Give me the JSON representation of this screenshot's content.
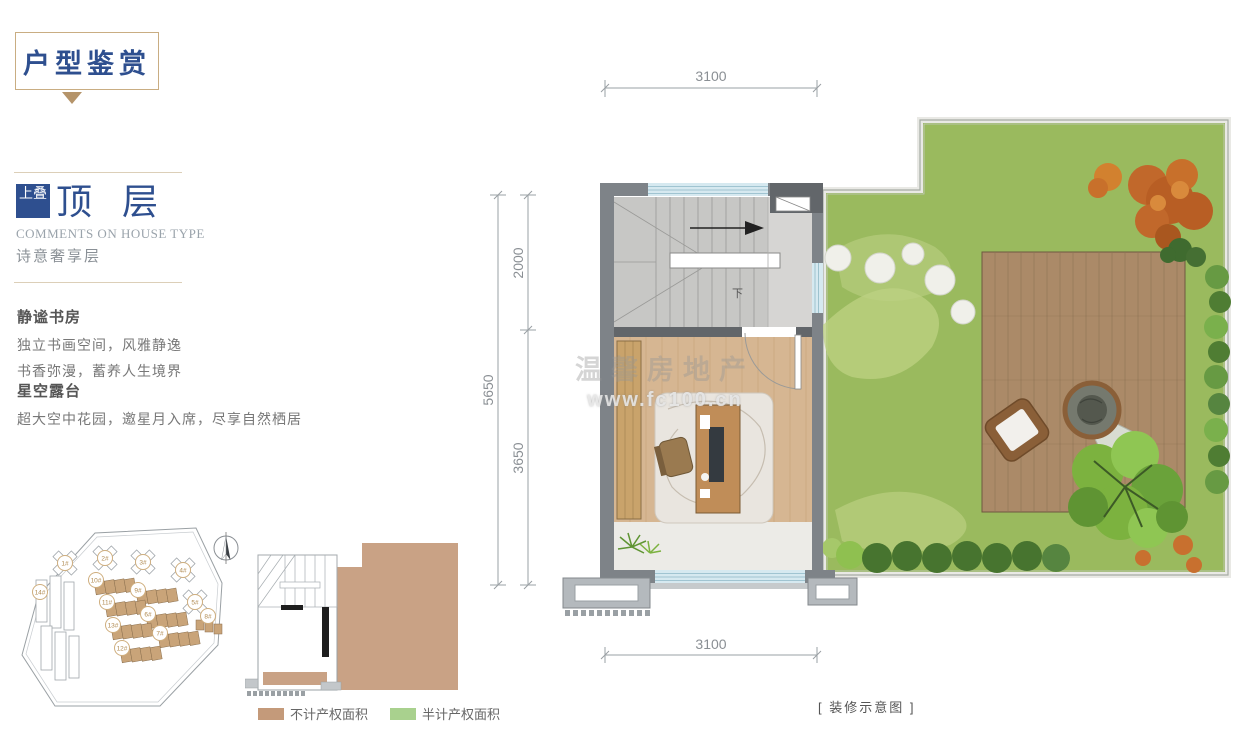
{
  "page": {
    "title": "户型鉴赏",
    "watermark_line1": "温馨房地产",
    "watermark_line2": "www.fc100.cn",
    "caption": "[ 装修示意图 ]",
    "accent_blue": "#2e4f8f",
    "accent_gold": "#c9ad82"
  },
  "left_panel": {
    "badge": "上叠",
    "heading": "顶 层",
    "subheading_en": "COMMENTS ON HOUSE TYPE",
    "subheading_cn": "诗意奢享层",
    "sections": [
      {
        "title": "静谧书房",
        "line1": "独立书画空间，风雅静逸",
        "line2": "书香弥漫，蓄养人生境界"
      },
      {
        "title": "星空露台",
        "line1": "超大空中花园，邀星月入席，尽享自然栖居"
      }
    ]
  },
  "floor_plan": {
    "dim_top": "3100",
    "dim_bottom": "3100",
    "dim_left_total": "5650",
    "dim_left_upper": "2000",
    "dim_left_lower": "3650",
    "stair_direction": "下"
  },
  "site_plan": {
    "buildings": [
      {
        "label": "1#"
      },
      {
        "label": "2#"
      },
      {
        "label": "3#"
      },
      {
        "label": "4#"
      },
      {
        "label": "5#"
      },
      {
        "label": "8#"
      },
      {
        "label": "14#"
      },
      {
        "label": "10#"
      },
      {
        "label": "9#"
      },
      {
        "label": "11#"
      },
      {
        "label": "6#"
      },
      {
        "label": "13#"
      },
      {
        "label": "7#"
      },
      {
        "label": "12#"
      }
    ]
  },
  "key_plan": {
    "legend": [
      {
        "label": "不计产权面积",
        "color": "#c49a7a"
      },
      {
        "label": "半计产权面积",
        "color": "#a9d18e"
      }
    ]
  }
}
